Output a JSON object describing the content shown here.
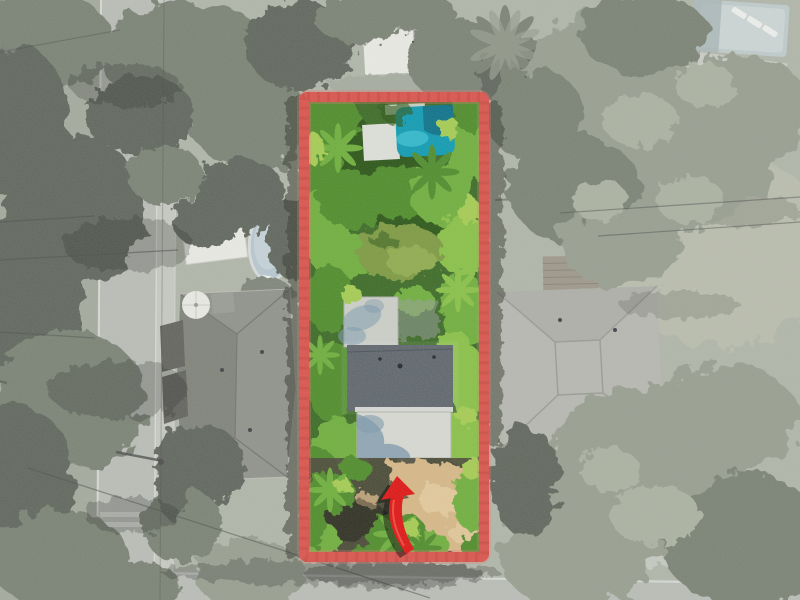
{
  "meta": {
    "type": "aerial-drone-photograph",
    "subject": "residential lot outlined in red, shown in full color while surroundings are desaturated",
    "visible_features": {
      "subject_lot": [
        "red property boundary rectangle",
        "dense tropical vegetation and palms",
        "teal swimming pool with white deck",
        "lawn patch",
        "house with white flat roof, dark gray shingle roof and white lower roof",
        "sandy driveway with green bushes",
        "red curved arrow marker pointing at house"
      ],
      "surroundings": [
        "vertical street with sidewalk and crosswalk on left",
        "horizontal street at bottom",
        "left neighbor house with hip roof, white shed, oval above-ground pool, umbrella, dark awnings",
        "right neighbor house with hip roof, wooden deck and lawn",
        "pool with loungers at top right",
        "large desaturated tree canopies",
        "power lines"
      ]
    }
  },
  "colors": {
    "bg": "#a9aea0",
    "bgLeft": "#9aa092",
    "haze": "#eceee9",
    "treeDark": "#4b5146",
    "treeMid": "#6b7263",
    "treeLight": "#8c9383",
    "treePale": "#a4aa98",
    "lawnRight": "#b3b6a5",
    "road": "#b4b6b0",
    "roadLight": "#c8cac3",
    "curb": "#e3e4e0",
    "sidewalk": "#c2c4bd",
    "wire": "#333333",
    "shadow": "#000000",
    "roofLeft": "#82847d",
    "roofLeftShade": "#707269",
    "roofEdge": "#c6c7c0",
    "ridge": "#616359",
    "shed": "#ecebe6",
    "hut": "#8e908a",
    "awning": "#4e4d48",
    "poolAbove": "#b1c2ce",
    "poolAboveIn": "#c3d0d8",
    "poolRim": "#d6dada",
    "patio": "#70746a",
    "deckWood": "#938b7c",
    "deckWoodLine": "#6f6a5e",
    "stepPad": "#a9a399",
    "roofRight": "#b0b0a9",
    "roofRightShade": "#a6a69f",
    "roofRightRidge": "#8f8f88",
    "poolTop": "#bac6c8",
    "poolTopLight": "#c9d3d4",
    "poolTopDark": "#9fadaf",
    "lounger": "#eff1ee",
    "darkStruct": "#2f3237",
    "groundPath": "#9aa093",
    "lotBase": "#3c6b26",
    "green1": "#2c5519",
    "green2": "#4f8d2c",
    "green3": "#6fb03c",
    "green4": "#a6cd52",
    "green5": "#8ac247",
    "lawnIn": "#7e9b43",
    "lawnIn2": "#90ad4f",
    "poolMain": "#0f9cb4",
    "poolLight": "#38c1d3",
    "poolDark": "#0a6c84",
    "deckWhite": "#dfe2da",
    "roofFlat": "#cdd0c9",
    "roofFlatEdge": "#aeb1aa",
    "roofDark": "#535b63",
    "roofDarkLine": "#3e454c",
    "eave": "#e6e7e2",
    "lowerWhite": "#d8dad3",
    "lowerEdge": "#b4b6b0",
    "shadowBlue": "#7e9aae",
    "step": "#c6c8c2",
    "pad": "#9aa0a0",
    "sand": "#d8b988",
    "sandLight": "#e9cfa2",
    "soil": "#4a4739",
    "darkStrip": "#34382f",
    "vent": "#22272c",
    "red": "#dc544d",
    "redDark": "#a93a34",
    "redGlow": "#e8776f",
    "arrow": "#e11414",
    "arrowHi": "#ff6a55"
  }
}
